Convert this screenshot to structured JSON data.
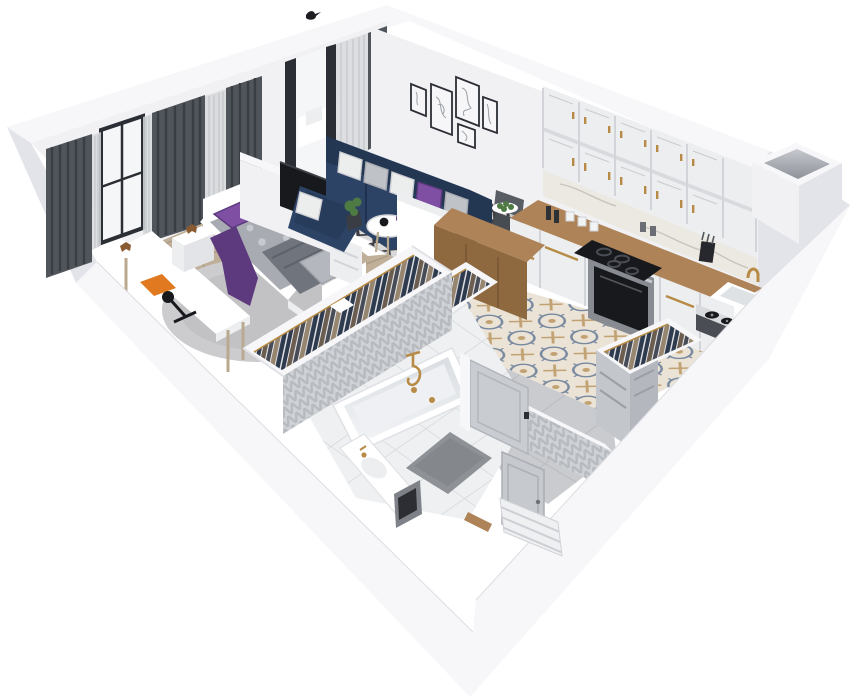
{
  "meta": {
    "title": "3D isometric cutaway floor plan render of a one-bedroom apartment",
    "view": "dollhouse axonometric from south-east, exterior walls full height, interior walls cut",
    "background": "#ffffff"
  },
  "palette": {
    "wall": "#f1f1f4",
    "wallShade": "#e3e4e9",
    "wallDark": "#d6d7dc",
    "cap": "#f7f7f9",
    "capEdge": "#dcdde2",
    "white": "#ffffff",
    "offWhite": "#eceef0",
    "glass": "#f4f6f7",
    "frameDark": "#2b2e34",
    "curtain": "#50555c",
    "curtainFold": "#393d44",
    "sheer": "#d7d9dc",
    "parquet": "#c0b09a",
    "parquetLine": "#aa9a84",
    "rugBedroom": "#cccccf",
    "rugLight": "#d9d9da",
    "rugDark": "#3b3c41",
    "navy": "#2d4365",
    "navyDark": "#233753",
    "purple": "#7e4fa3",
    "purpleDeep": "#5d3a7d",
    "mattress": "#a8abb2",
    "blanket": "#70747c",
    "wood": "#ae8357",
    "woodDark": "#8e6940",
    "gold": "#b78b45",
    "steel": "#9aa0a6",
    "black": "#17191d",
    "tileCream": "#ebe4d6",
    "tileBlue": "#76879f",
    "tileTan": "#c2a173",
    "grayTile": "#c9cbce",
    "grayTileLine": "#b6b8bc",
    "bathTile": "#eef0f2",
    "bathTileLine": "#d4d8db",
    "chevA": "#b7bbc0",
    "chevB": "#cfd3d7",
    "matGray": "#8e9297",
    "clothesA": "#2e3a4e",
    "clothesB": "#6b5d4f",
    "clothesC": "#474c56",
    "clothesD": "#97866f",
    "plant": "#4e7a43",
    "orange": "#e0791f",
    "ovenSteel": "#888b91"
  },
  "scene": {
    "rooms": [
      {
        "name": "bedroom",
        "floor": "wood parquet with round fluffy rug",
        "furniture": [
          "white daybed with gray floral bedding",
          "purple pillows and purple throw",
          "white nightstand with wooden toy dog",
          "white desk with orange book and black desk lamp",
          "dark gray blackout curtains",
          "sheer curtain",
          "black framed window",
          "wall-mounted black TV",
          "white dresser"
        ]
      },
      {
        "name": "balcony",
        "floor": "narrow strip behind glass wall",
        "furniture": [
          "dark sliding door frame",
          "sheer curtains",
          "white bench"
        ]
      },
      {
        "name": "living-room",
        "floor": "wood with black and white geometric rug",
        "furniture": [
          "navy corner sofa with white, gray and purple cushions",
          "round white coffee table with camera and purple vase",
          "gallery of five line-art frames",
          "gray desk chair",
          "wooden sideboard desk",
          "potted plant",
          "small black bird on wall top"
        ]
      },
      {
        "name": "kitchen",
        "floor": "ornate blue and tan patterned cement tiles",
        "furniture": [
          "white shaker upper cabinets with gold handles (two rows)",
          "marble backsplash",
          "L-shaped wooden countertop",
          "black induction cooktop",
          "stainless oven",
          "white sink with gold faucet",
          "knife block and spice jars",
          "plate of green apples",
          "record player turntable",
          "ventilation shaft"
        ]
      },
      {
        "name": "hallway",
        "floor": "wood and patterned tile",
        "furniture": [
          "long open wardrobe full of hanging clothes on gold hangers",
          "second open wardrobe",
          "third open wardrobe with gray drawer cabinet"
        ]
      },
      {
        "name": "bathroom",
        "floor": "large white tiles with gray mats",
        "furniture": [
          "white bathtub with gold shower fixture",
          "gray chevron tiled walls",
          "white vanity slab with gold faucet",
          "dark laundry cabinet",
          "open light-gray panel door"
        ]
      },
      {
        "name": "entry",
        "floor": "large gray tiles",
        "furniture": [
          "entry door in wall recess",
          "exterior staircase steps",
          "wooden threshold"
        ]
      }
    ]
  }
}
